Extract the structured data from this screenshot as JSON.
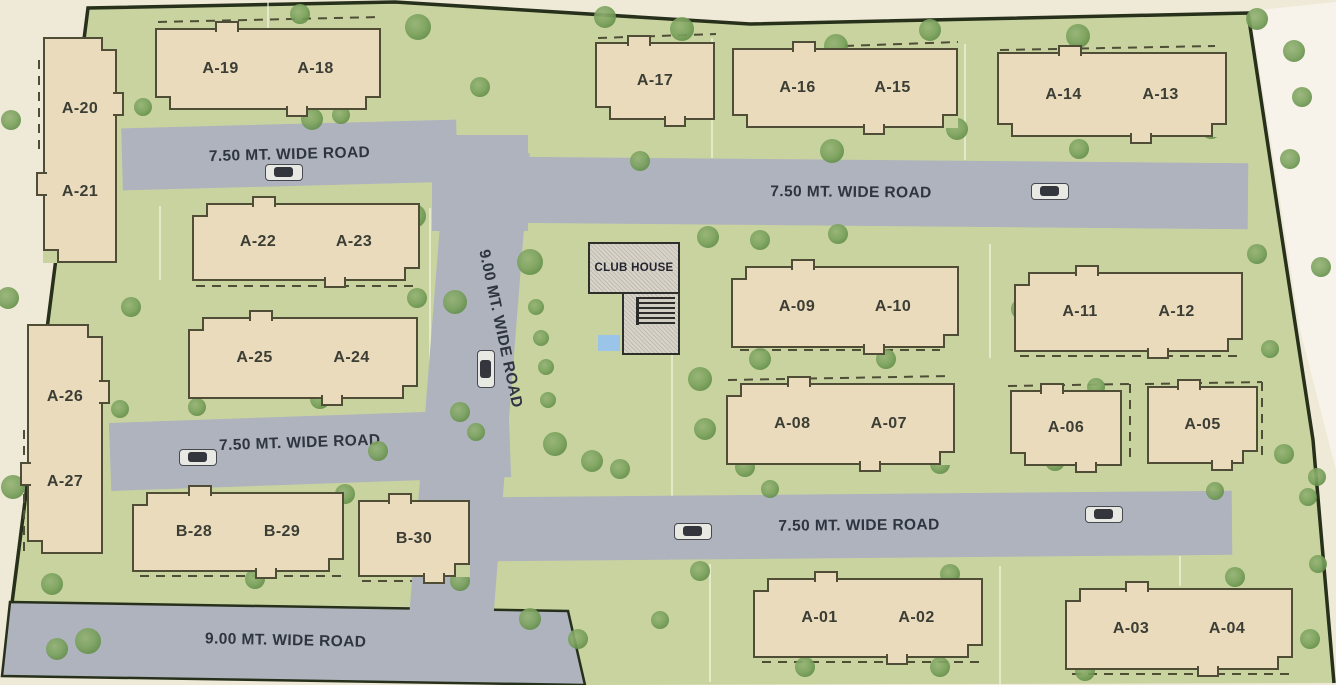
{
  "title": "Residential site layout plan",
  "roads": {
    "w750": "7.50 MT. WIDE ROAD",
    "w900": "9.00 MT. WIDE ROAD"
  },
  "club_house": {
    "label": "CLUB HOUSE"
  },
  "blocks": [
    {
      "id": "A-20/A-21",
      "labels": [
        "A-20",
        "A-21"
      ]
    },
    {
      "id": "A-19/A-18",
      "labels": [
        "A-19",
        "A-18"
      ]
    },
    {
      "id": "A-17",
      "labels": [
        "A-17"
      ]
    },
    {
      "id": "A-16/A-15",
      "labels": [
        "A-16",
        "A-15"
      ]
    },
    {
      "id": "A-14/A-13",
      "labels": [
        "A-14",
        "A-13"
      ]
    },
    {
      "id": "A-22/A-23",
      "labels": [
        "A-22",
        "A-23"
      ]
    },
    {
      "id": "A-25/A-24",
      "labels": [
        "A-25",
        "A-24"
      ]
    },
    {
      "id": "A-26/A-27",
      "labels": [
        "A-26",
        "A-27"
      ]
    },
    {
      "id": "B-28/B-29",
      "labels": [
        "B-28",
        "B-29"
      ]
    },
    {
      "id": "B-30",
      "labels": [
        "B-30"
      ]
    },
    {
      "id": "A-09/A-10",
      "labels": [
        "A-09",
        "A-10"
      ]
    },
    {
      "id": "A-11/A-12",
      "labels": [
        "A-11",
        "A-12"
      ]
    },
    {
      "id": "A-08/A-07",
      "labels": [
        "A-08",
        "A-07"
      ]
    },
    {
      "id": "A-06",
      "labels": [
        "A-06"
      ]
    },
    {
      "id": "A-05",
      "labels": [
        "A-05"
      ]
    },
    {
      "id": "A-01/A-02",
      "labels": [
        "A-01",
        "A-02"
      ]
    },
    {
      "id": "A-03/A-04",
      "labels": [
        "A-03",
        "A-04"
      ]
    }
  ],
  "colors": {
    "green": "#c9d3a0",
    "road": "#aeb3bd",
    "bldg": "#e9dbbb",
    "line": "#4f4d36",
    "boundary": "#26301b",
    "outside": "#efe9d7",
    "tree": "#7ba25d",
    "roadtext": "#2f3540",
    "pool": "#9ac4e8",
    "ch": "#d8d4ca"
  },
  "trees": [
    [
      93,
      57,
      14
    ],
    [
      11,
      120,
      10
    ],
    [
      8,
      298,
      11
    ],
    [
      13,
      487,
      12
    ],
    [
      38,
      468,
      10
    ],
    [
      88,
      641,
      13
    ],
    [
      57,
      649,
      11
    ],
    [
      300,
      14,
      10
    ],
    [
      418,
      27,
      13
    ],
    [
      605,
      17,
      11
    ],
    [
      682,
      29,
      12
    ],
    [
      836,
      46,
      12
    ],
    [
      930,
      30,
      11
    ],
    [
      1078,
      36,
      12
    ],
    [
      1257,
      19,
      11
    ],
    [
      1294,
      51,
      11
    ],
    [
      480,
      87,
      10
    ],
    [
      143,
      107,
      9
    ],
    [
      312,
      119,
      11
    ],
    [
      341,
      115,
      9
    ],
    [
      414,
      216,
      12
    ],
    [
      95,
      161,
      9
    ],
    [
      530,
      262,
      13
    ],
    [
      455,
      302,
      12
    ],
    [
      536,
      307,
      8
    ],
    [
      541,
      338,
      8
    ],
    [
      546,
      367,
      8
    ],
    [
      548,
      400,
      8
    ],
    [
      460,
      412,
      10
    ],
    [
      476,
      432,
      9
    ],
    [
      640,
      161,
      10
    ],
    [
      832,
      151,
      12
    ],
    [
      957,
      129,
      11
    ],
    [
      1079,
      149,
      10
    ],
    [
      1211,
      129,
      10
    ],
    [
      1290,
      159,
      10
    ],
    [
      1302,
      97,
      10
    ],
    [
      131,
      307,
      10
    ],
    [
      417,
      298,
      10
    ],
    [
      660,
      277,
      12
    ],
    [
      708,
      237,
      11
    ],
    [
      760,
      240,
      10
    ],
    [
      838,
      234,
      10
    ],
    [
      1022,
      309,
      11
    ],
    [
      1257,
      254,
      10
    ],
    [
      1321,
      267,
      10
    ],
    [
      700,
      379,
      12
    ],
    [
      705,
      429,
      11
    ],
    [
      760,
      359,
      11
    ],
    [
      886,
      359,
      10
    ],
    [
      1048,
      341,
      10
    ],
    [
      1096,
      387,
      9
    ],
    [
      1270,
      349,
      9
    ],
    [
      1180,
      425,
      9
    ],
    [
      120,
      409,
      9
    ],
    [
      197,
      407,
      9
    ],
    [
      320,
      399,
      10
    ],
    [
      378,
      451,
      10
    ],
    [
      555,
      444,
      12
    ],
    [
      592,
      461,
      11
    ],
    [
      620,
      469,
      10
    ],
    [
      745,
      467,
      10
    ],
    [
      940,
      464,
      10
    ],
    [
      1055,
      461,
      10
    ],
    [
      1284,
      454,
      10
    ],
    [
      1317,
      477,
      9
    ],
    [
      770,
      489,
      9
    ],
    [
      1215,
      491,
      9
    ],
    [
      1308,
      497,
      9
    ],
    [
      345,
      494,
      10
    ],
    [
      305,
      529,
      8
    ],
    [
      52,
      584,
      11
    ],
    [
      255,
      579,
      10
    ],
    [
      460,
      581,
      10
    ],
    [
      700,
      571,
      10
    ],
    [
      950,
      574,
      10
    ],
    [
      1235,
      577,
      10
    ],
    [
      1318,
      564,
      9
    ],
    [
      530,
      619,
      11
    ],
    [
      578,
      639,
      10
    ],
    [
      660,
      620,
      9
    ],
    [
      805,
      667,
      10
    ],
    [
      940,
      667,
      10
    ],
    [
      1085,
      671,
      10
    ],
    [
      1310,
      639,
      10
    ]
  ],
  "cars": [
    {
      "x": 284,
      "y": 172,
      "o": "h"
    },
    {
      "x": 1050,
      "y": 191,
      "o": "h"
    },
    {
      "x": 486,
      "y": 369,
      "o": "v"
    },
    {
      "x": 198,
      "y": 457,
      "o": "h"
    },
    {
      "x": 693,
      "y": 531,
      "o": "h"
    },
    {
      "x": 1104,
      "y": 514,
      "o": "h"
    }
  ]
}
